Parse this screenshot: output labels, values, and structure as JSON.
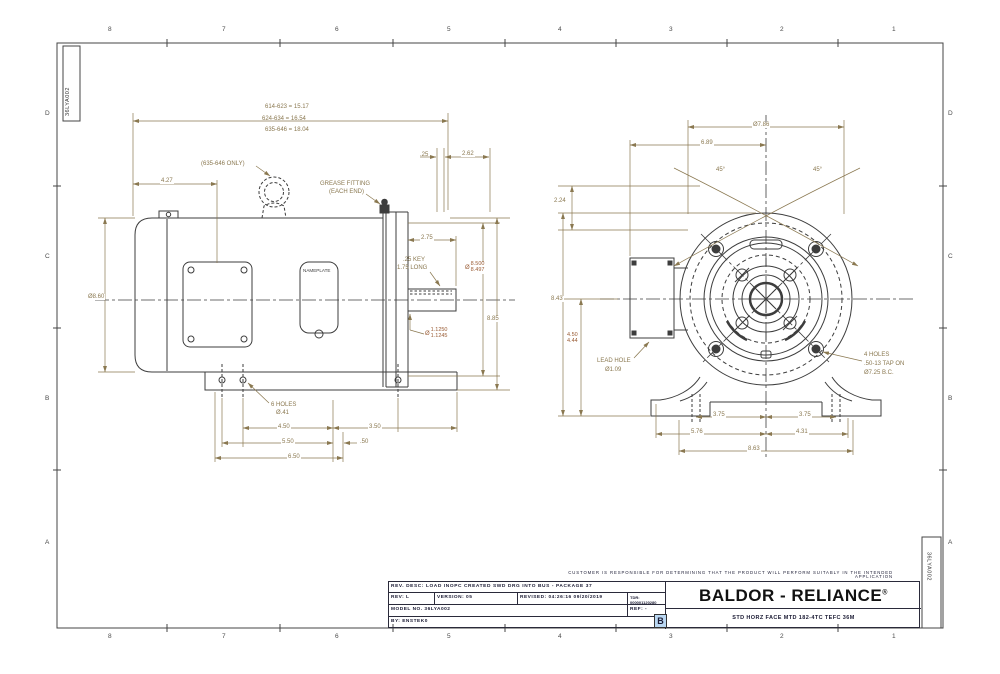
{
  "colors": {
    "geometry": "#3d3d3d",
    "dimension": "#8a7850",
    "tolerance_dim": "#9a5c35",
    "title_text": "#1a1a33",
    "size_marker_highlight": "#b9d7f2"
  },
  "zones": {
    "cols": [
      "8",
      "7",
      "6",
      "5",
      "4",
      "3",
      "2",
      "1"
    ],
    "rows": [
      "D",
      "C",
      "B",
      "A"
    ]
  },
  "part_labels": {
    "top_left": "36LYA002",
    "bottom_right": "36LYA002"
  },
  "side_view": {
    "length_table": [
      "614-623 = 15.17",
      "624-634 = 16.54",
      "635-646 = 18.04"
    ],
    "eyebolt_note": "(635-646 ONLY)",
    "grease_note_1": "GREASE FITTING",
    "grease_note_2": "(EACH END)",
    "nameplate": "NAMEPLATE",
    "dim_25": ".25",
    "dim_262": "2.62",
    "dim_427": "4.27",
    "dia_body": "Ø8.60",
    "dim_275": "2.75",
    "key_note_1": ".25 KEY",
    "key_note_2": "1.75 LONG",
    "dia_face_sym": "Ø",
    "dia_face_hi": "8.500",
    "dia_face_lo": "8.497",
    "dim_height": "8.85",
    "dia_shaft_sym": "Ø",
    "dia_shaft_hi": "1.1250",
    "dia_shaft_lo": "1.1245",
    "holes_note_1": "6 HOLES",
    "holes_note_2": "Ø.41",
    "dim_450": "4.50",
    "dim_350": "3.50",
    "dim_550": "5.50",
    "dim_050": ".50",
    "dim_650": "6.50"
  },
  "front_view": {
    "dia_outer": "Ø7.86",
    "dim_689": "6.89",
    "angle_left": "45°",
    "angle_right": "45°",
    "dim_224": "2.24",
    "dim_843": "8.43",
    "dim_d_hi": "4.50",
    "dim_d_lo": "4.44",
    "lead_note_1": "LEAD HOLE",
    "lead_note_2": "Ø1.09",
    "tap_note_1": "4 HOLES",
    "tap_note_2": ".50-13 TAP ON",
    "tap_note_3": "Ø7.25 B.C.",
    "dim_375_left": "3.75",
    "dim_375_right": "3.75",
    "dim_576": "5.76",
    "dim_431": "4.31",
    "dim_863": "8.63"
  },
  "title_block": {
    "disclaimer": "CUSTOMER IS RESPONSIBLE FOR DETERMINING THAT THE PRODUCT WILL PERFORM SUITABLY IN THE INTENDED APPLICATION",
    "rev_desc": "REV. DESC: LOAD INOPC CREATED SWD DRG INTO BUS - PACKAGE 37",
    "rev": "REV:  L",
    "version": "VERSION:  05",
    "revised": "REVISED:  04:26:16 09/20/2019",
    "tdr": "TDR:  000001120280",
    "model_no": "MODEL NO.  36LYA002",
    "ref": "REF:  -",
    "by": "BY:  ENSTEK0",
    "brand": "BALDOR - RELIANCE",
    "brand_reg": "®",
    "size_marker": "B",
    "description": "STD HORZ FACE MTD 182-4TC TEFC 36M"
  }
}
